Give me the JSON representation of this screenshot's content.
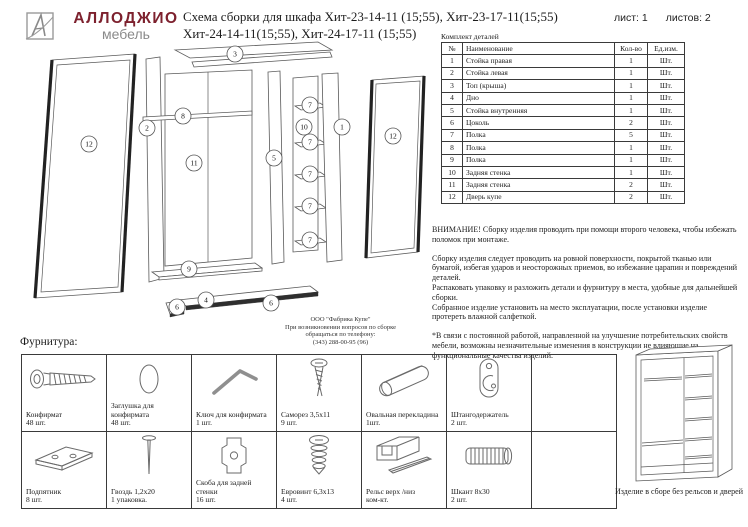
{
  "colors": {
    "brand": "#7d212e",
    "line_art": "#5a5a5a"
  },
  "header": {
    "logo": {
      "brand": "АЛЛОДЖИО",
      "sub": "мебель"
    },
    "title_line1": "Схема сборки для шкафа Хит-23-14-11 (15;55), Хит-23-17-11(15;55)",
    "title_line2": "Хит-24-14-11(15;55), Хит-24-17-11 (15;55)",
    "sheet_label": "лист: 1",
    "sheets_label": "листов: 2"
  },
  "parts_table": {
    "caption": "Комплект деталей",
    "columns": [
      "№",
      "Наименование",
      "Кол-во",
      "Ед.изм."
    ],
    "rows": [
      {
        "num": "1",
        "name": "Стойка правая",
        "qty": "1",
        "unit": "Шт."
      },
      {
        "num": "2",
        "name": "Стойка левая",
        "qty": "1",
        "unit": "Шт."
      },
      {
        "num": "3",
        "name": "Топ (крыша)",
        "qty": "1",
        "unit": "Шт."
      },
      {
        "num": "4",
        "name": "Дно",
        "qty": "1",
        "unit": "Шт."
      },
      {
        "num": "5",
        "name": "Стойка внутренняя",
        "qty": "1",
        "unit": "Шт."
      },
      {
        "num": "6",
        "name": "Цоколь",
        "qty": "2",
        "unit": "Шт."
      },
      {
        "num": "7",
        "name": "Полка",
        "qty": "5",
        "unit": "Шт."
      },
      {
        "num": "8",
        "name": "Полка",
        "qty": "1",
        "unit": "Шт."
      },
      {
        "num": "9",
        "name": "Полка",
        "qty": "1",
        "unit": "Шт."
      },
      {
        "num": "10",
        "name": "Задняя стенка",
        "qty": "1",
        "unit": "Шт."
      },
      {
        "num": "11",
        "name": "Задняя стенка",
        "qty": "2",
        "unit": "Шт."
      },
      {
        "num": "12",
        "name": "Дверь купе",
        "qty": "2",
        "unit": "Шт."
      }
    ]
  },
  "notes": {
    "warning": "ВНИМАНИЕ! Сборку изделия проводить при помощи второго человека, чтобы избежать поломок при монтаже.",
    "p1": "Сборку изделия следует проводить на ровной поверхности, покрытой тканью или бумагой, избегая ударов и неосторожных приемов, во избежание царапин и повреждений деталей.",
    "p2": "Распаковать упаковку и разложить детали и фурнитуру в места, удобные для дальнейшей сборки.",
    "p3": "Собранное изделие установить на место эксплуатации, после установки изделие протереть влажной салфеткой.",
    "footnote": "*В связи с постоянной работой, направленной на улучшение потребительских свойств мебели, возможны незначительные изменения в конструкции не влияющие на функциональные качества изделий."
  },
  "contact": {
    "company": "ООО \"Фабрика Купе\"",
    "line1": "При возникновении вопросов по сборке",
    "line2": "обращаться по телефону:",
    "phone": "(343) 288-00-95 (96)"
  },
  "diagram": {
    "callouts": [
      "3",
      "12",
      "2",
      "8",
      "11",
      "9",
      "5",
      "10",
      "7",
      "7",
      "7",
      "7",
      "7",
      "1",
      "12",
      "4",
      "6",
      "6"
    ]
  },
  "hardware": {
    "section_title": "Фурнитура:",
    "items": [
      {
        "name": "Конфирмат",
        "qty": "48 шт."
      },
      {
        "name": "Заглушка для конфирмата",
        "qty": "48 шт."
      },
      {
        "name": "Ключ для конфирмата",
        "qty": "1 шт."
      },
      {
        "name": "Саморез 3,5х11",
        "qty": "9 шт."
      },
      {
        "name": "Овальная перекладина",
        "qty": "1шт."
      },
      {
        "name": "Штангодержатель",
        "qty": "2 шт."
      },
      {
        "name": "Подпятник",
        "qty": "8 шт."
      },
      {
        "name": "Гвоздь 1,2х20",
        "qty": "1 упаковка."
      },
      {
        "name": "Скоба для задней стенки",
        "qty": "16 шт."
      },
      {
        "name": "Евровинт 6,3х13",
        "qty": "4 шт."
      },
      {
        "name": "Рельс верх /низ",
        "qty": "ком-кт."
      },
      {
        "name": "Шкант 8х30",
        "qty": "2 шт."
      }
    ],
    "assembled_caption": "Изделие в сборе без рельсов и дверей"
  }
}
